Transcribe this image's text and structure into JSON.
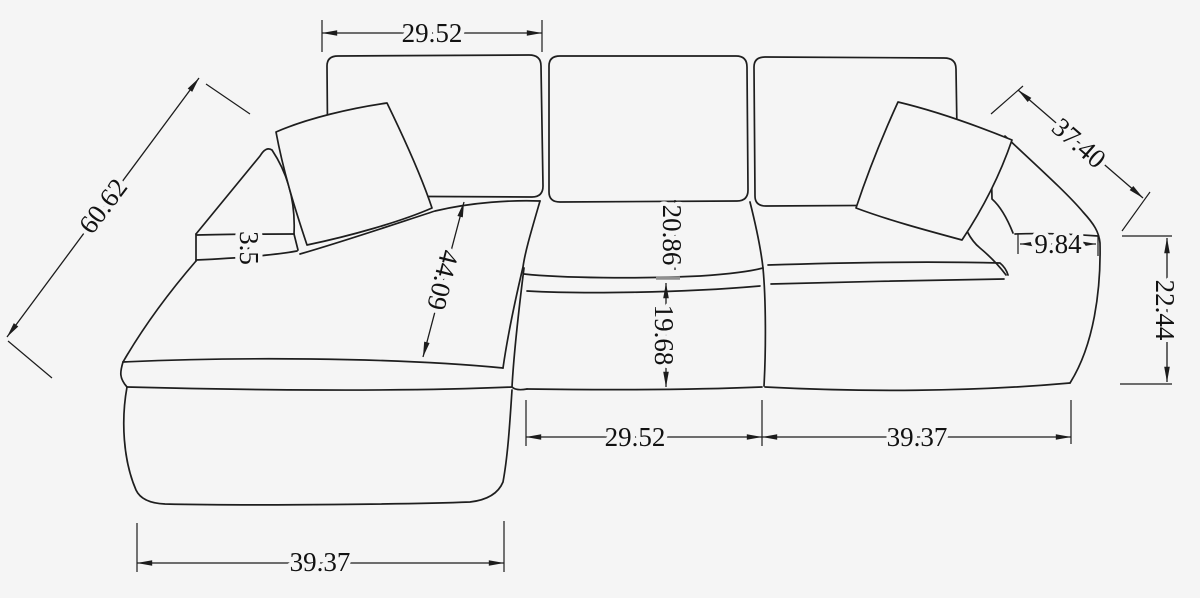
{
  "canvas": {
    "background": "#f5f5f5",
    "line_color": "#1e1e1e",
    "text_color": "#121212"
  },
  "diagram": {
    "type": "sectional-sofa-dimension-drawing",
    "dims": {
      "top_back_cushion_width": "29.52",
      "chaise_total_depth": "60.62",
      "left_arm_pad_thickness": "3.5",
      "chaise_seat_length": "44.09",
      "seat_depth": "20.86",
      "seat_front_height": "19.68",
      "right_arm_slope_depth": "37.40",
      "right_arm_width": "9.84",
      "right_arm_height": "22.44",
      "middle_seat_width": "29.52",
      "right_section_width": "39.37",
      "chaise_width": "39.37"
    }
  }
}
